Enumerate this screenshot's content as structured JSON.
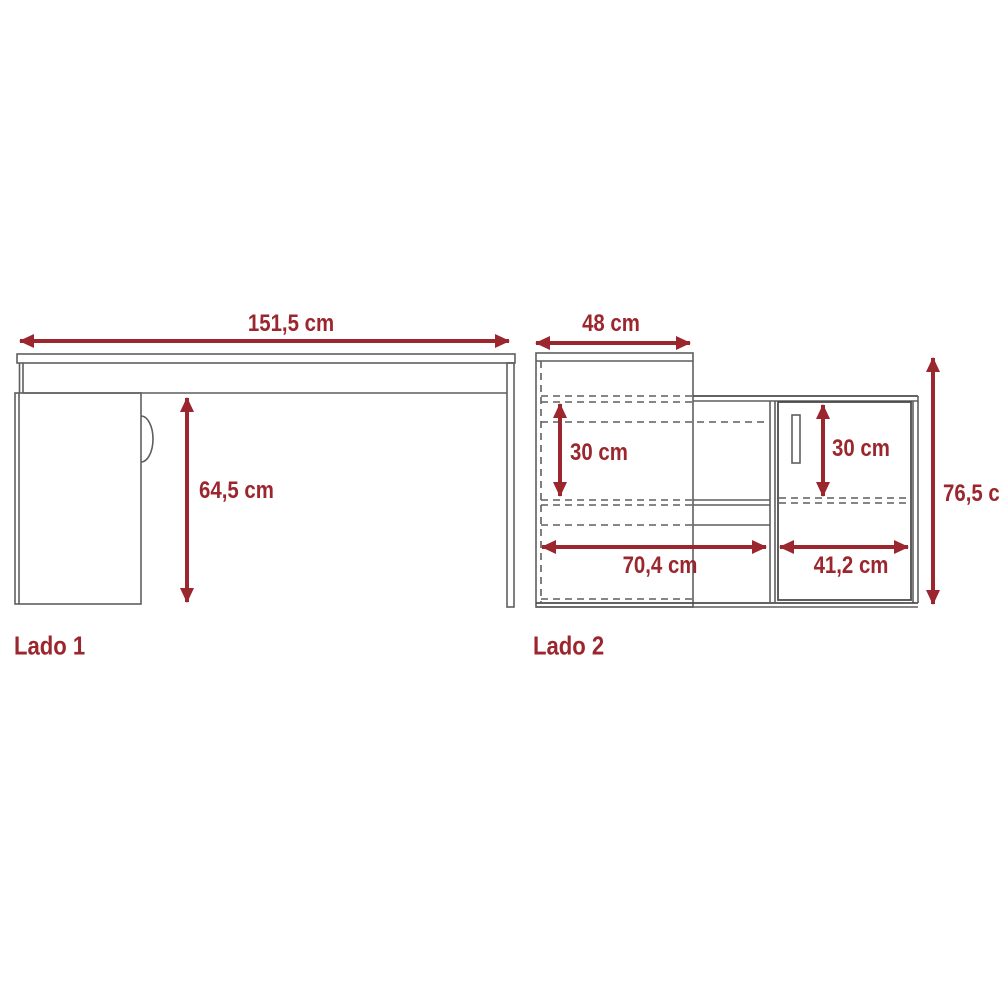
{
  "title": "Furniture dimension diagram (desk, two views)",
  "units": "cm",
  "colors": {
    "dimension": "#9C262D",
    "line": "#5F5F5F"
  },
  "views": [
    {
      "id": "lado1",
      "label": "Lado 1",
      "dimensions": [
        {
          "name": "desk-width",
          "value": "151,5 cm"
        },
        {
          "name": "desk-underside-height",
          "value": "64,5 cm"
        }
      ]
    },
    {
      "id": "lado2",
      "label": "Lado 2",
      "dimensions": [
        {
          "name": "tall-cabinet-depth",
          "value": "48 cm"
        },
        {
          "name": "left-compartment-height",
          "value": "30 cm"
        },
        {
          "name": "door-compartment-height",
          "value": "30 cm"
        },
        {
          "name": "left-section-width",
          "value": "70,4 cm"
        },
        {
          "name": "door-section-width",
          "value": "41,2 cm"
        },
        {
          "name": "total-height",
          "value": "76,5 cm"
        }
      ]
    }
  ]
}
